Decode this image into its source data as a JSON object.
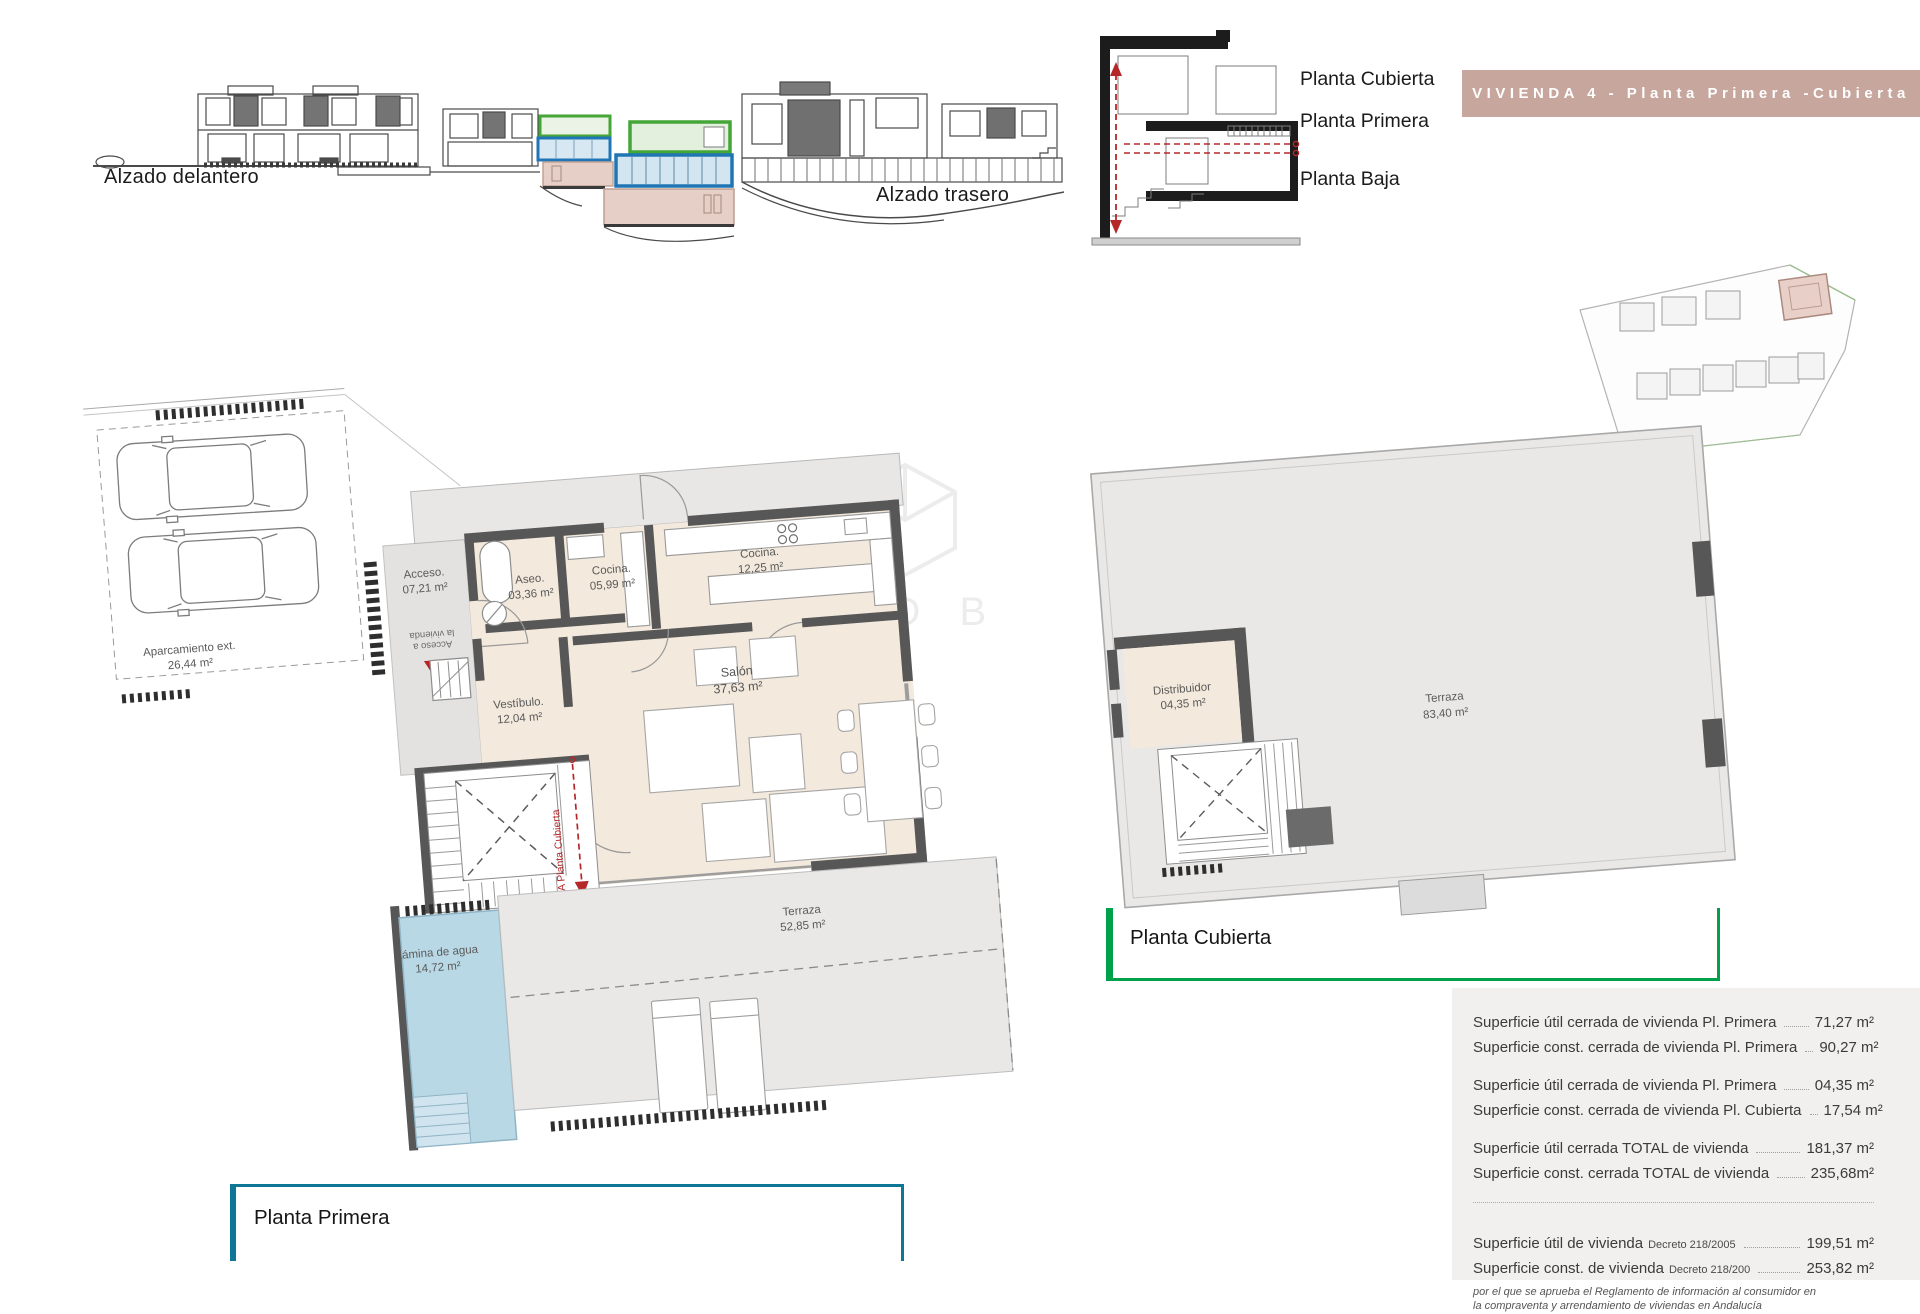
{
  "header": {
    "banner": "VIVIENDA 4 - Planta Primera -Cubierta"
  },
  "elevations": {
    "front": "Alzado delantero",
    "rear": "Alzado trasero"
  },
  "section": {
    "floors": [
      "Planta Cubierta",
      "Planta Primera",
      "Planta Baja"
    ]
  },
  "plan_primera": {
    "title": "Planta Primera",
    "rooms": {
      "aparcamiento": {
        "name": "Aparcamiento ext.",
        "area": "26,44 m²"
      },
      "acceso": {
        "name": "Acceso.",
        "area": "07,21 m²"
      },
      "aseo": {
        "name": "Aseo.",
        "area": "03,36 m²"
      },
      "cocina_small": {
        "name": "Cocina.",
        "area": "05,99 m²"
      },
      "cocina_large": {
        "name": "Cocina.",
        "area": "12,25 m²"
      },
      "salon": {
        "name": "Salón",
        "area": "37,63 m²"
      },
      "vestibulo": {
        "name": "Vestíbulo.",
        "area": "12,04 m²"
      },
      "lamina": {
        "name": "Lámina de agua",
        "area": "14,72 m²"
      },
      "terraza": {
        "name": "Terraza",
        "area": "52,85 m²"
      }
    },
    "annotations": {
      "access_1": "Acceso a",
      "access_2": "la vivienda",
      "to_cubierta": "A Planta Cubierta"
    }
  },
  "plan_cubierta": {
    "title": "Planta Cubierta",
    "rooms": {
      "distribuidor": {
        "name": "Distribuidor",
        "area": "04,35 m²"
      },
      "terraza": {
        "name": "Terraza",
        "area": "83,40 m²"
      }
    }
  },
  "summary": {
    "rows": [
      {
        "label": "Superficie útil cerrada de vivienda Pl. Primera",
        "value": "71,27 m²"
      },
      {
        "label": "Superficie const. cerrada de vivienda Pl. Primera",
        "value": "90,27 m²"
      },
      {
        "label": "Superficie útil cerrada de vivienda Pl. Primera",
        "value": "04,35 m²"
      },
      {
        "label": "Superficie const. cerrada de vivienda Pl. Cubierta",
        "value": "17,54 m²"
      },
      {
        "label": "Superficie útil cerrada TOTAL de vivienda",
        "value": "181,37 m²"
      },
      {
        "label": "Superficie const. cerrada TOTAL de vivienda",
        "value": "235,68m²"
      },
      {
        "label": "Superficie útil de vivienda",
        "small": "Decreto 218/2005",
        "value": "199,51 m²"
      },
      {
        "label": "Superficie const. de vivienda",
        "small": "Decreto 218/200",
        "value": "253,82 m²"
      }
    ],
    "footnote": "por el que se aprueba el Reglamento de información al consumidor en la compraventa y arrendamiento de viviendas en Andalucía"
  },
  "watermark": "GOLD B",
  "colors": {
    "banner_bg": "#c6a69d",
    "accent_red": "#b5282a",
    "bracket_primera": "#0e7796",
    "bracket_cubierta": "#00a14b",
    "highlight_green": "#44a636",
    "highlight_blue": "#2076b4",
    "highlight_pink": "#e6cfc6"
  }
}
